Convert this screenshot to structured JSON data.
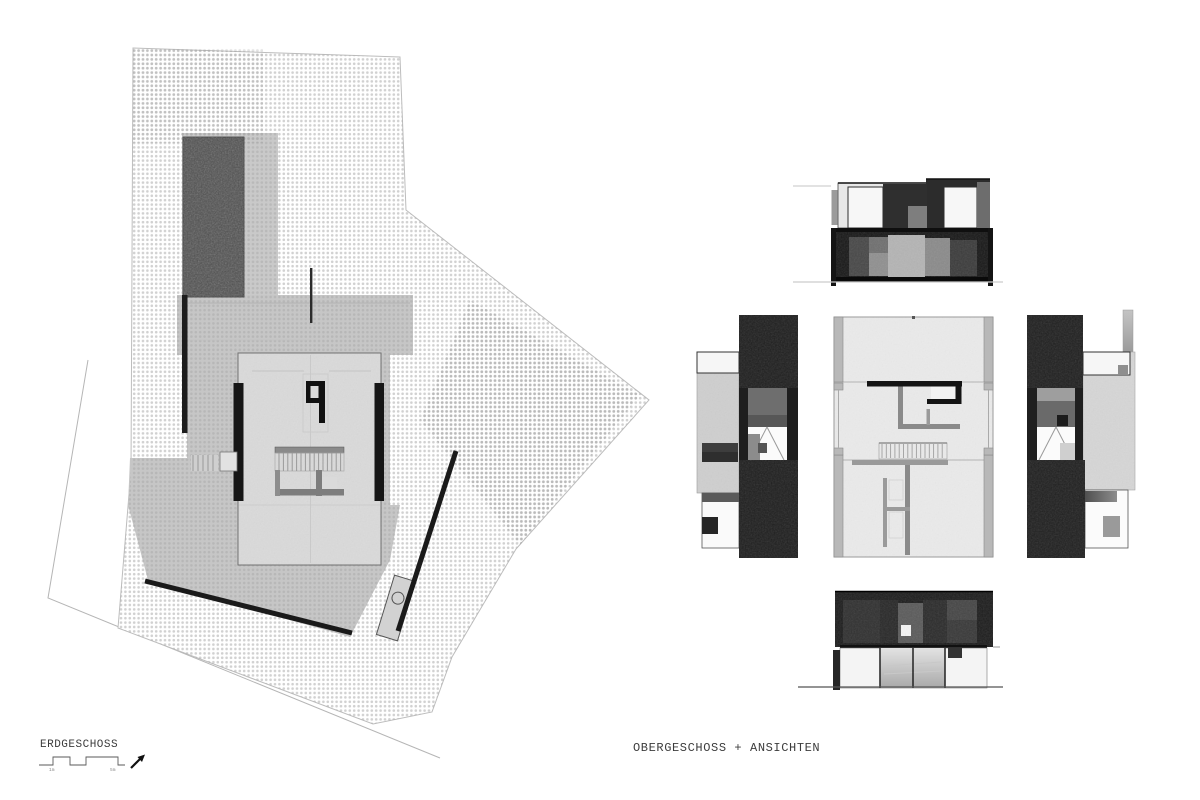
{
  "document": {
    "background": "#ffffff"
  },
  "labels": {
    "ground_floor_title": "ERDGESCHOSS",
    "upper_floor_title": "OBERGESCHOSS + ANSICHTEN"
  },
  "scale_bar": {
    "labels": [
      "1m",
      "5m"
    ]
  },
  "palette": {
    "paper": "#ffffff",
    "ink": "#1a1a1a",
    "halftone_dot": "#ababab",
    "terrace_gray": "#c6c6c6",
    "building_fill": "#dadada",
    "plan_fill": "#eaeaea",
    "dark_mass": "#1f1f1f",
    "pool_dark": "#4e4e4e",
    "light_band": "#d2d2d2",
    "wall_gray": "#8a8a8a"
  }
}
